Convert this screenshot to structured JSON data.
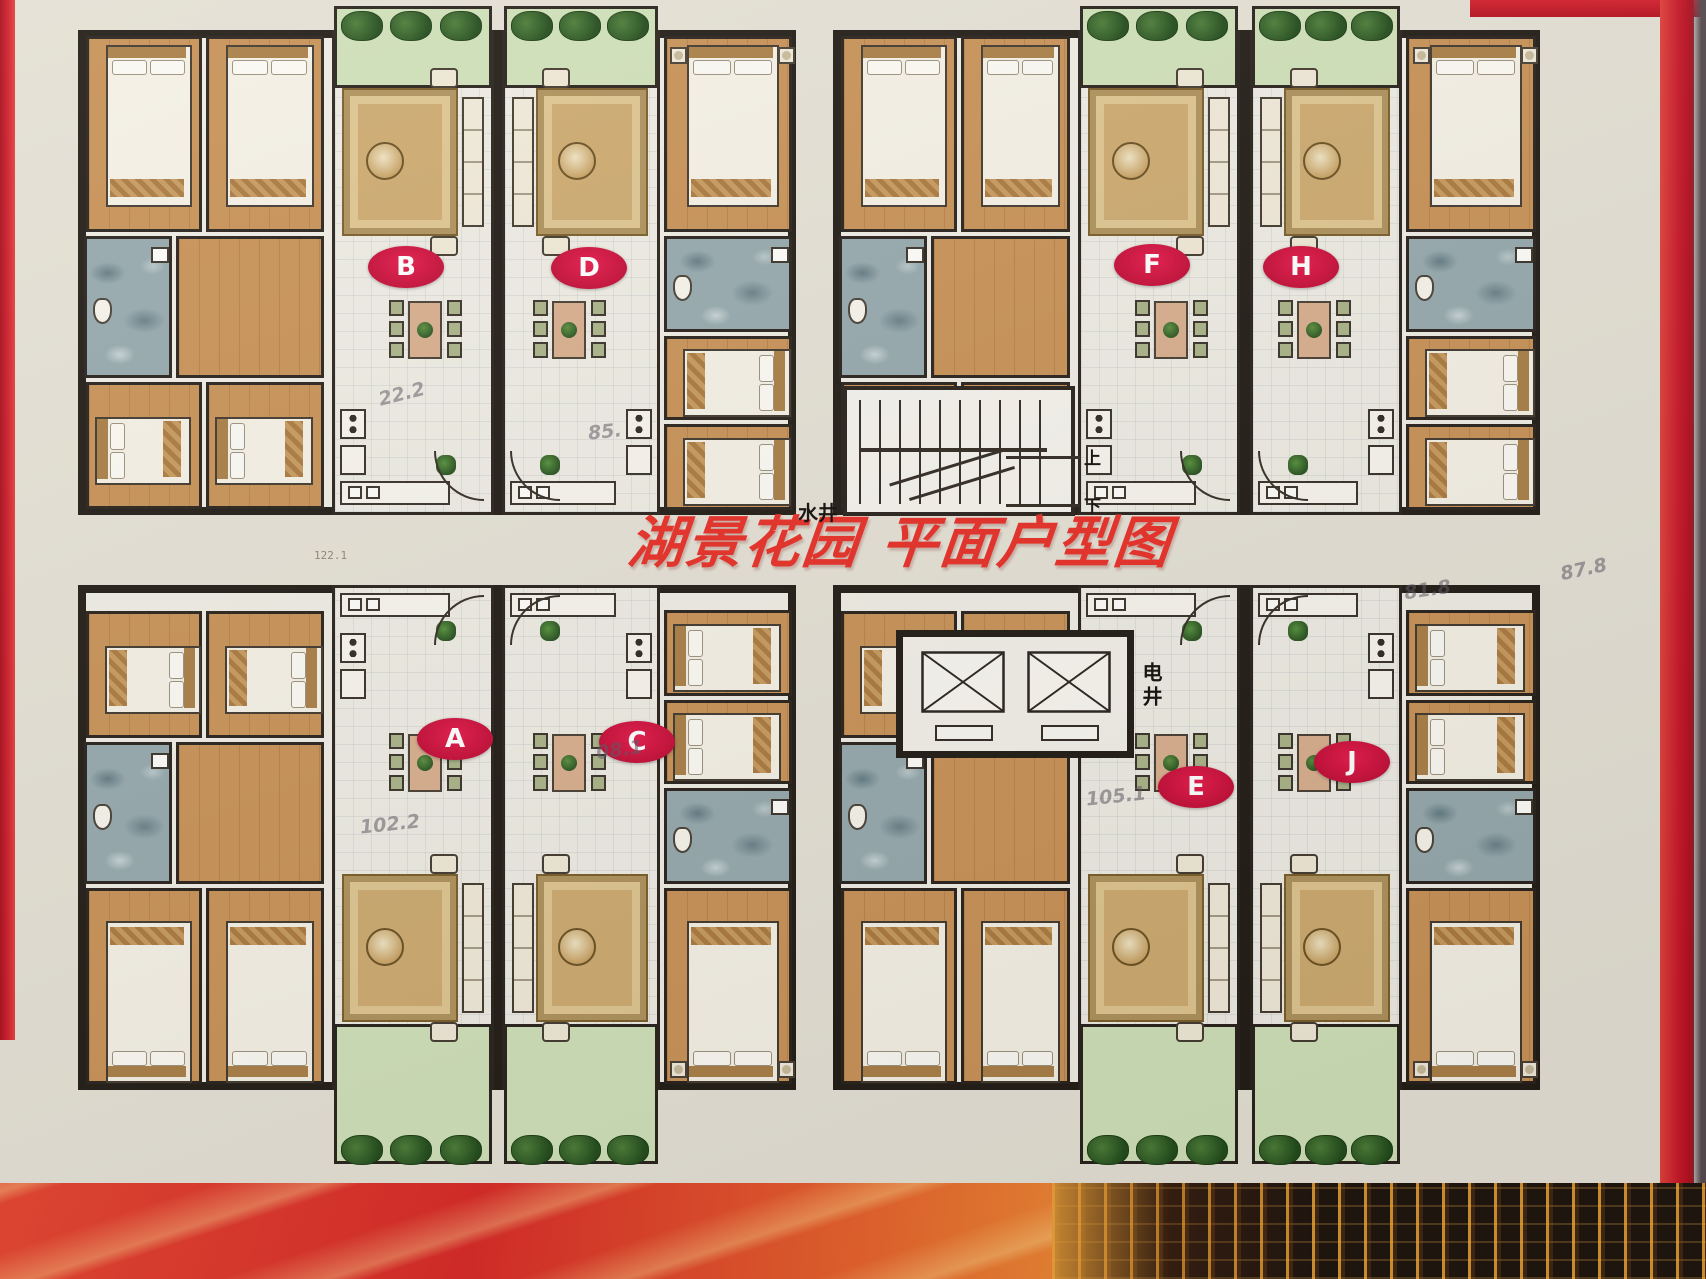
{
  "title": {
    "text": "湖景花园 平面户型图"
  },
  "core": {
    "water_shaft": "水井",
    "electric_shaft": "电井",
    "stair_up": "上",
    "stair_down": "下"
  },
  "units": [
    {
      "label": "B",
      "position": "left building, upper-left unit"
    },
    {
      "label": "D",
      "position": "left building, upper-right unit"
    },
    {
      "label": "A",
      "position": "left building, lower-left unit"
    },
    {
      "label": "C",
      "position": "left building, lower-right unit"
    },
    {
      "label": "F",
      "position": "right building, upper-left unit"
    },
    {
      "label": "H",
      "position": "right building, upper-right unit"
    },
    {
      "label": "E",
      "position": "right building, lower-left unit"
    },
    {
      "label": "J",
      "position": "right building, lower-right unit"
    }
  ],
  "annotations": [
    {
      "text": "22.2",
      "kind": "hand"
    },
    {
      "text": "85.",
      "kind": "hand"
    },
    {
      "text": "08.1",
      "kind": "hand"
    },
    {
      "text": "102.2",
      "kind": "hand"
    },
    {
      "text": "105.1",
      "kind": "hand"
    },
    {
      "text": "122.1",
      "kind": "print"
    },
    {
      "text": "87.8",
      "kind": "hand"
    },
    {
      "text": "81.8",
      "kind": "hand"
    }
  ],
  "colors": {
    "title_red": "#e73028",
    "label_red": "#d41744",
    "wall_black": "#231d17",
    "wood_floor": "#c89257",
    "bath_slate": "#96a9ad",
    "balcony_green": "#cfe0b8",
    "carpet_tan": "#cdaa70",
    "poster_cream": "#eeece3",
    "banner_red": "#d92b28"
  }
}
